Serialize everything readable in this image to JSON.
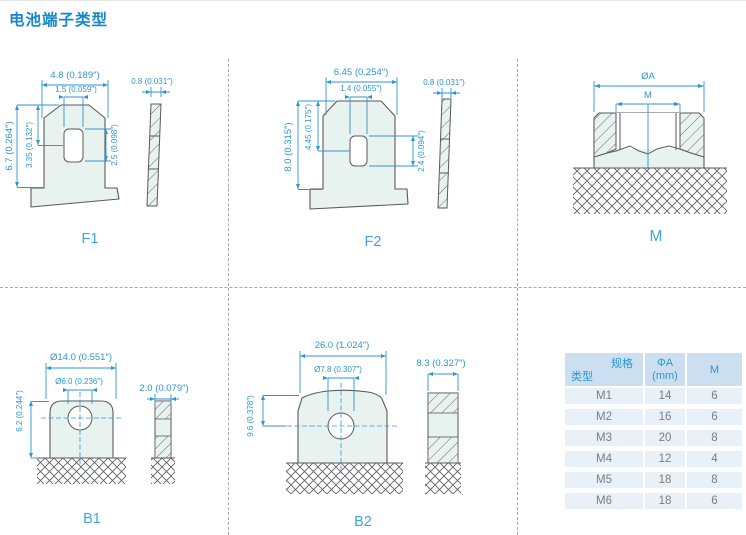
{
  "title": "电池端子类型",
  "appearance": {
    "accent_blue": "#2d96d2",
    "title_blue": "#1786ca",
    "label_blue": "#42a4de",
    "outline_gray": "#595a5c",
    "shape_fill": "#e8f2ee",
    "table_header_bg": "#cbdff0",
    "table_row_bg": "#e8f1f8",
    "table_row_text": "#7d7d7d",
    "grid_dash_gray": "#a8a8a8"
  },
  "panels": {
    "f1": {
      "label": "F1",
      "dims": {
        "top_width": "4.8 (0.189″)",
        "hole_width": "1.5 (0.059″)",
        "thickness": "0.8 (0.031″)",
        "height": "6.7 (0.264″)",
        "upper_height": "3.35 (0.132″)",
        "hole_height": "2.5 (0.098″)"
      }
    },
    "f2": {
      "label": "F2",
      "dims": {
        "top_width": "6.45 (0.254″)",
        "hole_width": "1.4 (0.055″)",
        "thickness": "0.8 (0.031″)",
        "height": "8.0 (0.315″)",
        "upper_height": "4.45 (0.175″)",
        "hole_height": "2.4 (0.094″)"
      }
    },
    "m": {
      "label": "M",
      "dims": {
        "outer_diameter": "ØA",
        "thread": "M"
      }
    },
    "b1": {
      "label": "B1",
      "dims": {
        "outer_diameter": "Ø14.0 (0.551″)",
        "hole_diameter": "Ø6.0 (0.236″)",
        "thickness": "2.0 (0.079″)",
        "height": "6.2 (0.244″)"
      }
    },
    "b2": {
      "label": "B2",
      "dims": {
        "width": "26.0 (1.024″)",
        "hole_diameter": "Ø7.8 (0.307″)",
        "thickness": "8.3 (0.327″)",
        "height": "9.6 (0.378″)"
      }
    }
  },
  "table": {
    "header": {
      "corner_top": "规格",
      "corner_bottom": "类型",
      "col2_line1": "ΦA",
      "col2_line2": "(mm)",
      "col3": "M"
    },
    "rows": [
      {
        "type": "M1",
        "phi_a": "14",
        "m": "6"
      },
      {
        "type": "M2",
        "phi_a": "16",
        "m": "6"
      },
      {
        "type": "M3",
        "phi_a": "20",
        "m": "8"
      },
      {
        "type": "M4",
        "phi_a": "12",
        "m": "4"
      },
      {
        "type": "M5",
        "phi_a": "18",
        "m": "8"
      },
      {
        "type": "M6",
        "phi_a": "18",
        "m": "6"
      }
    ]
  }
}
